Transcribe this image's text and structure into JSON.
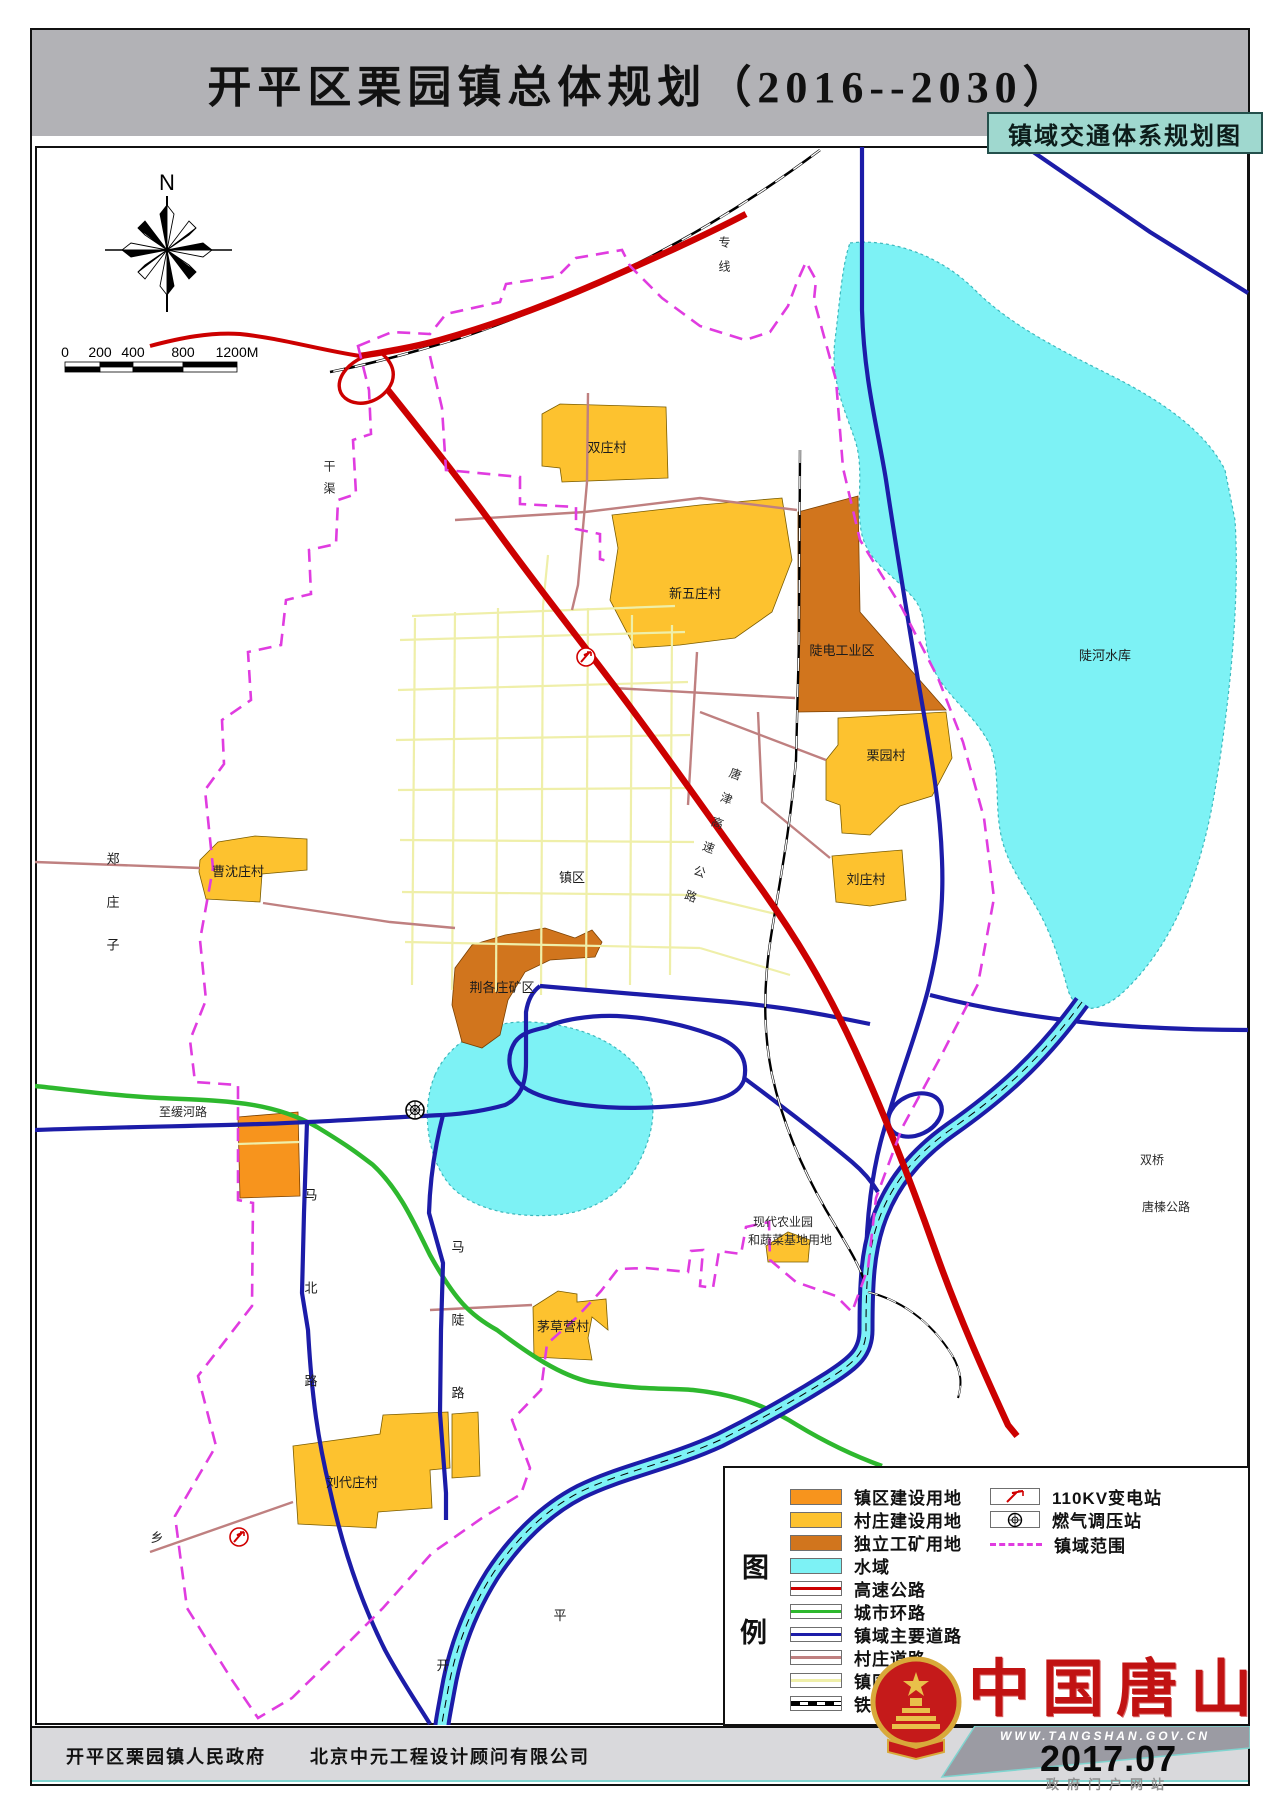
{
  "title": "开平区栗园镇总体规划（2016--2030）",
  "subtitle": "镇域交通体系规划图",
  "compass": {
    "north_label": "N"
  },
  "scale_bar": {
    "ticks": [
      "0",
      "200",
      "400",
      "800",
      "1200M"
    ]
  },
  "legend": {
    "title_chars": [
      "图",
      "例"
    ],
    "left_items": [
      {
        "label": "镇区建设用地",
        "type": "area",
        "color": "#F7941D"
      },
      {
        "label": "村庄建设用地",
        "type": "area",
        "color": "#FDC22F"
      },
      {
        "label": "独立工矿用地",
        "type": "area",
        "color": "#D1751D"
      },
      {
        "label": "水域",
        "type": "area",
        "color": "#7DF2F5"
      },
      {
        "label": "高速公路",
        "type": "line",
        "color": "#CC0000"
      },
      {
        "label": "城市环路",
        "type": "line",
        "color": "#2EB82E"
      },
      {
        "label": "镇域主要道路",
        "type": "line",
        "color": "#1C1CA8"
      },
      {
        "label": "村庄道路",
        "type": "line",
        "color": "#BF8080"
      },
      {
        "label": "镇区道路",
        "type": "line",
        "color": "#EFEFA9"
      },
      {
        "label": "铁路",
        "type": "railway",
        "color": "#000000"
      }
    ],
    "right_items": [
      {
        "label": "110KV变电站",
        "type": "substation-symbol"
      },
      {
        "label": "燃气调压站",
        "type": "gas-symbol"
      },
      {
        "label": "镇域范围",
        "type": "dashed-line",
        "color": "#E03CE0"
      }
    ]
  },
  "map_labels": {
    "shuangzhuangcun": "双庄村",
    "xinwuzhuangcun": "新五庄村",
    "doudian_industrial": "陡电工业区",
    "liyuancun": "栗园村",
    "liuzhuangcun": "刘庄村",
    "caoshenzhuangcun": "曹沈庄村",
    "zhenqu": "镇区",
    "jinggezhuang_mine": "荆各庄矿区",
    "douhe_reservoir": "陡河水库",
    "agri_line1": "现代农业园",
    "agri_line2": "和蔬菜基地用地",
    "maocaoyingcun": "茅草营村",
    "liudaizhuangcun": "刘代庄村",
    "zhihuanhelu": "至缓河路",
    "shuangqiao": "双桥",
    "tangzhen_highway": "唐榛公路",
    "zhengzhuangzi": "郑庄子",
    "ganqu": "干渠",
    "zhuanxian": "专线",
    "tangjin_expressway": "唐津高速公路",
    "mabeilu": "马北路",
    "madoulu": "马陡路",
    "xiang": "乡",
    "kai": "开",
    "ping": "平"
  },
  "footer": {
    "gov": "开平区栗园镇人民政府",
    "designer": "北京中元工程设计顾问有限公司"
  },
  "branding": {
    "site_name": "中国唐山",
    "url": "WWW.TANGSHAN.GOV.CN",
    "date": "2017.07",
    "tagline": "政府门户网站"
  },
  "colors": {
    "town_construction": "#F7941D",
    "village_construction": "#FDC22F",
    "industrial": "#D1751D",
    "water": "#7DF2F5",
    "expressway": "#CC0000",
    "ring_road": "#2EB82E",
    "main_road": "#1C1CA8",
    "village_road": "#BF8080",
    "town_road": "#EFEFA9",
    "railway": "#000000",
    "boundary": "#E03CE0",
    "subtitle_bg": "#9FD8CF",
    "title_band_bg": "#B2B2B6",
    "brand_red": "#C11212"
  }
}
